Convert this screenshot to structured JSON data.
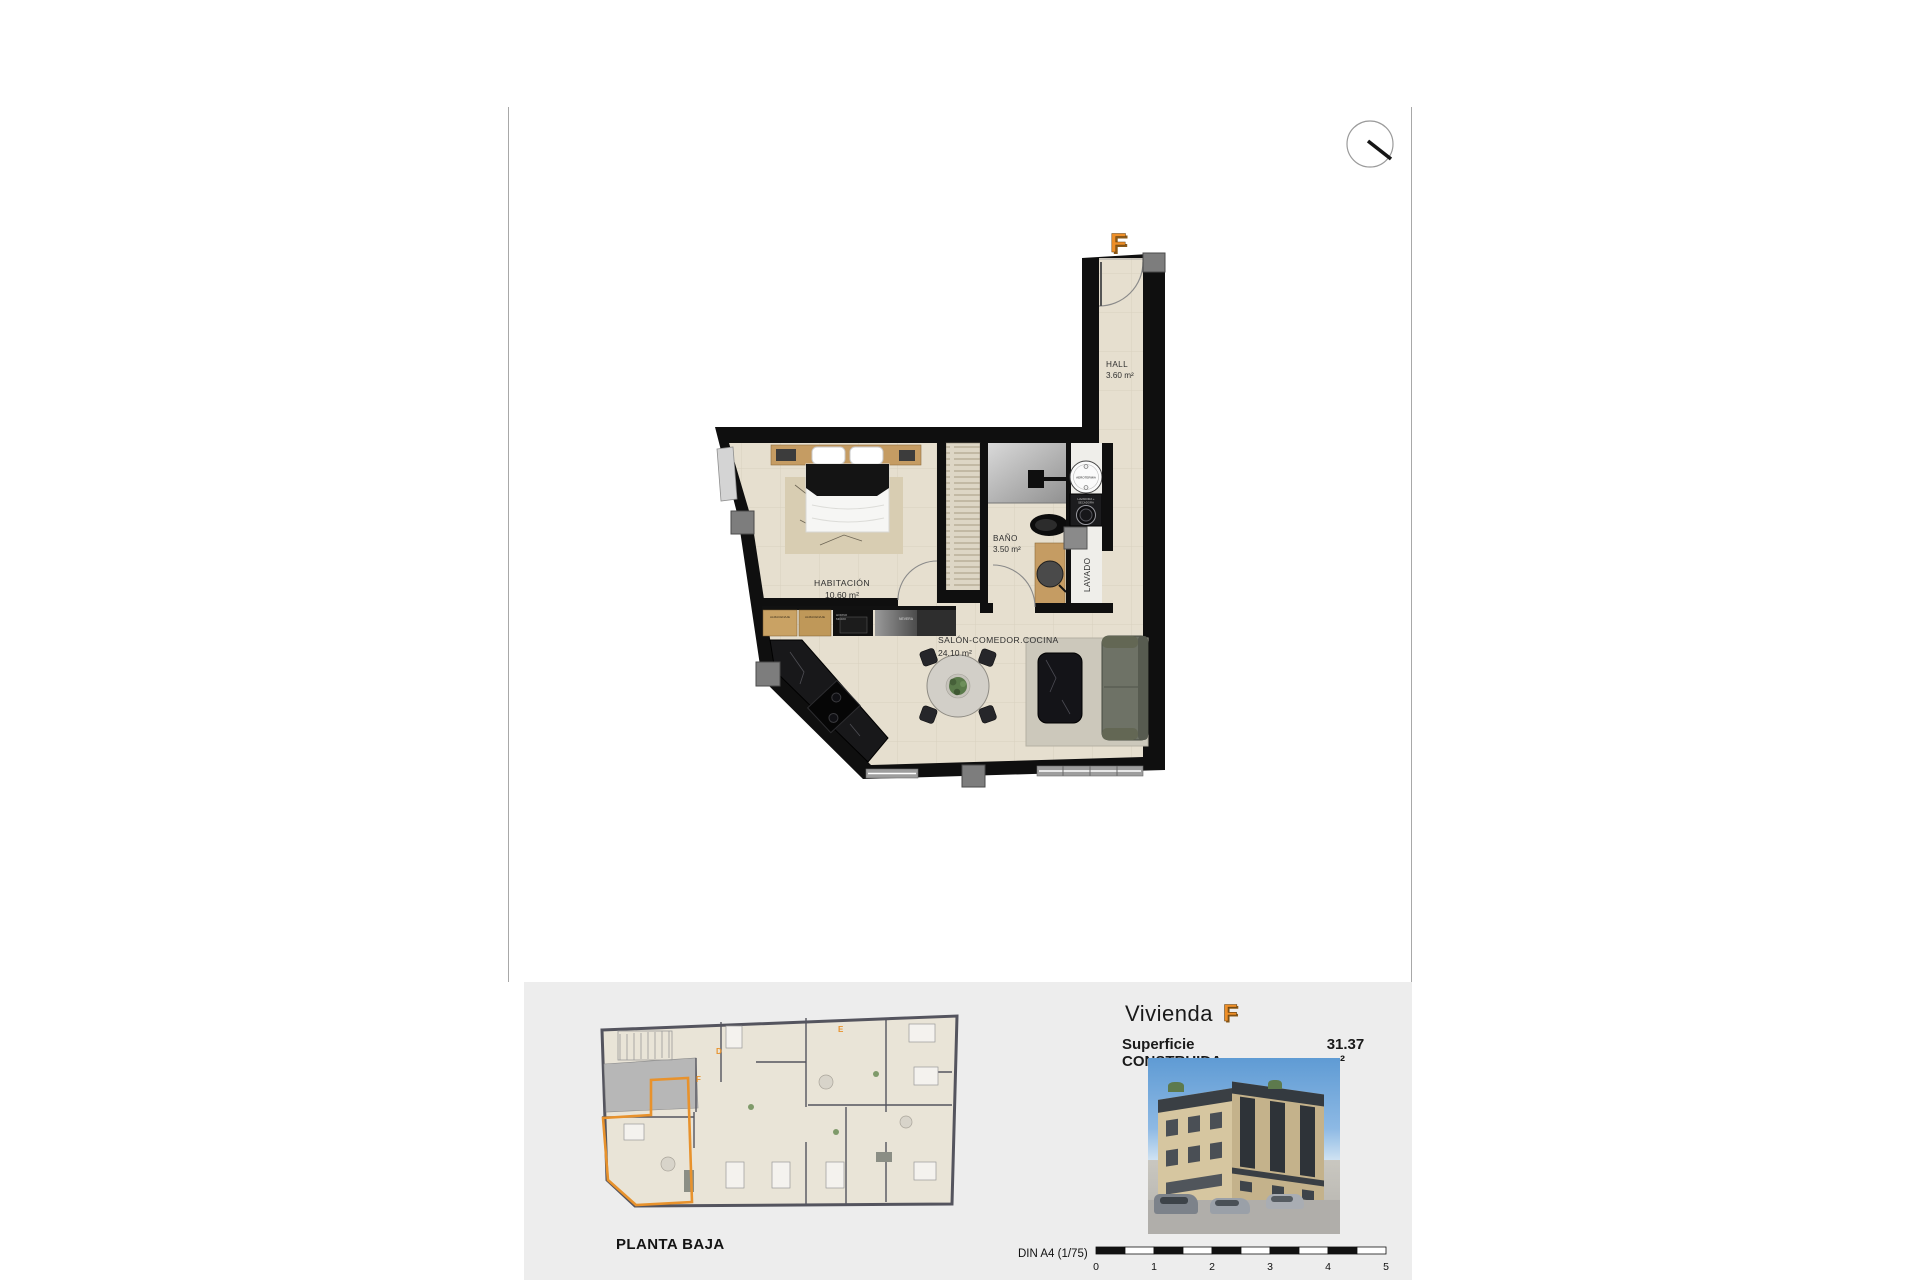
{
  "plan": {
    "unit_marker": "F",
    "rooms": {
      "hall": {
        "name": "HALL",
        "area": "3.60 m²"
      },
      "bathroom": {
        "name": "BAÑO",
        "area": "3.50 m²"
      },
      "bedroom": {
        "name": "HABITACIÓN",
        "area": "10.60 m²"
      },
      "living": {
        "name": "SALÓN-COMEDOR.COCINA",
        "area": "24.10 m²"
      },
      "laundry": {
        "name": "LAVADO"
      }
    },
    "labels": {
      "aerotermia": "AEROTERMIA",
      "washer_line1": "LAVADORA +",
      "washer_line2": "SECADORA",
      "cabinet1": "ALMACENAJE",
      "cabinet2": "ALMACENAJE",
      "oven_line1": "HORNO",
      "oven_line2": "MICRO",
      "fridge": "NEVERA"
    }
  },
  "footer": {
    "overview_caption": "PLANTA BAJA",
    "overview_units": {
      "d": "D",
      "e": "E",
      "f": "F"
    },
    "title": {
      "prefix": "Vivienda",
      "unit": "F"
    },
    "surface": {
      "label": "Superficie CONSTRUIDA",
      "value": "31.37 m²"
    },
    "scale": {
      "label": "DIN A4 (1/75)",
      "ticks": [
        "0",
        "1",
        "2",
        "3",
        "4",
        "5"
      ]
    }
  },
  "colors": {
    "accent_orange": "#ee8f28",
    "wall_black": "#0f0f0f",
    "floor_beige": "#e6dfcf",
    "band_gray": "#ededed"
  }
}
